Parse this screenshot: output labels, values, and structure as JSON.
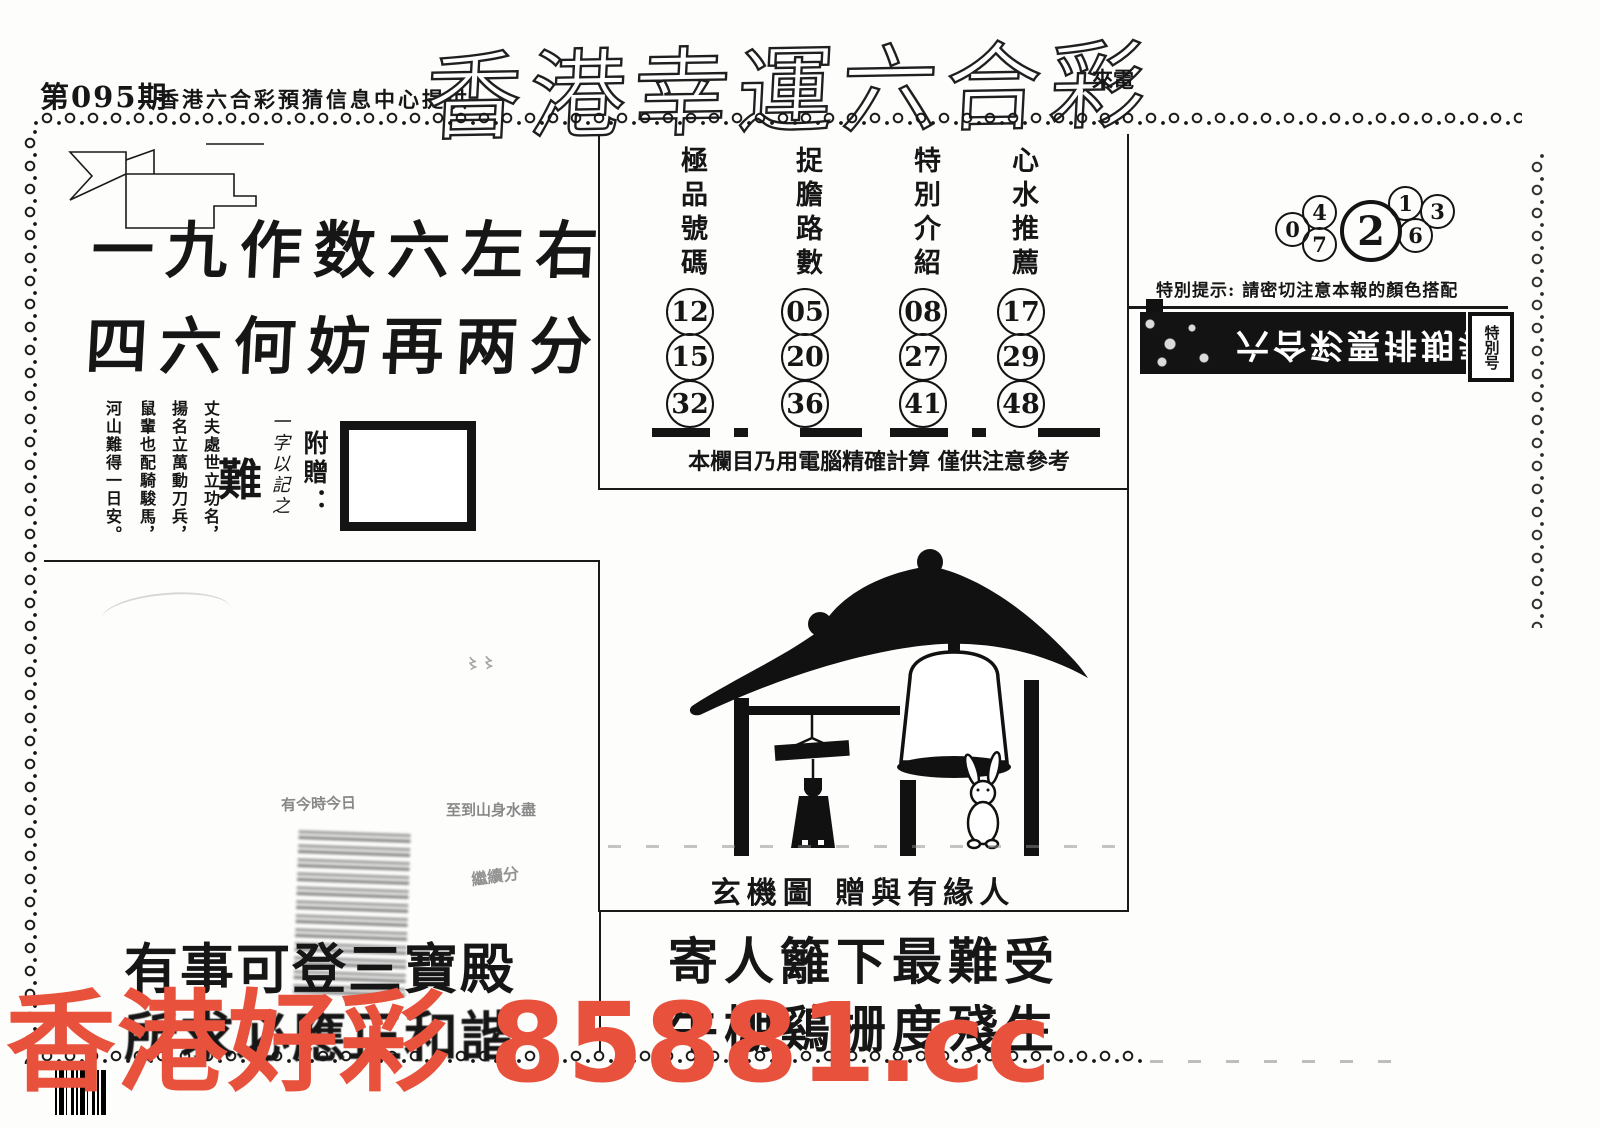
{
  "header": {
    "issue": "第095期",
    "provider": "香港六合彩預猜信息中心提供",
    "title": "香港幸運六合彩",
    "note": "來電"
  },
  "left_section": {
    "verse_line1": "一九作数六左右",
    "verse_line2": "四六何妨再两分",
    "gift_label": "附贈：",
    "gift_note": "一字以記之",
    "gift_char": "難",
    "poem_columns": [
      "丈夫處世立功名，",
      "揚名立萬動刀兵，",
      "鼠輩也配騎駿馬，",
      "河山難得一日安。"
    ]
  },
  "tips": {
    "columns": [
      {
        "header": "極品號碼",
        "numbers": [
          "12",
          "15",
          "32"
        ]
      },
      {
        "header": "捉膽路數",
        "numbers": [
          "05",
          "20",
          "36"
        ]
      },
      {
        "header": "特別介紹",
        "numbers": [
          "08",
          "27",
          "41"
        ]
      },
      {
        "header": "心水推薦",
        "numbers": [
          "17",
          "29",
          "48"
        ]
      }
    ],
    "footnote": "本欄目乃用電腦精確計算 僅供注意參考"
  },
  "special_box": {
    "digit_far_left": "0",
    "digit_top_left": "4",
    "digit_bottom_left": "7",
    "digit_main": "2",
    "digit_top_right": "1",
    "digit_bottom_right": "6",
    "digit_far_right": "3",
    "notice": "特別提示: 請密切注意本報的顏色搭配"
  },
  "banner": {
    "mirrored_title": "六合彩票排期表",
    "side_label": "特別号"
  },
  "mystic": {
    "caption": "玄機圖 贈與有緣人"
  },
  "bottom": {
    "left_line1": "有事可登三寶殿",
    "left_line2": "所求必應正和諧",
    "right_line1": "寄人籬下最難受",
    "right_line2": "牛棚鷄栅度殘生"
  },
  "smudge_fragments": [
    "有今時今日",
    "至到山身水盡",
    "繼續分"
  ],
  "watermark": {
    "text": "香港好彩 85881.cc",
    "color": "#e8523d"
  },
  "ink_color": "#161616"
}
